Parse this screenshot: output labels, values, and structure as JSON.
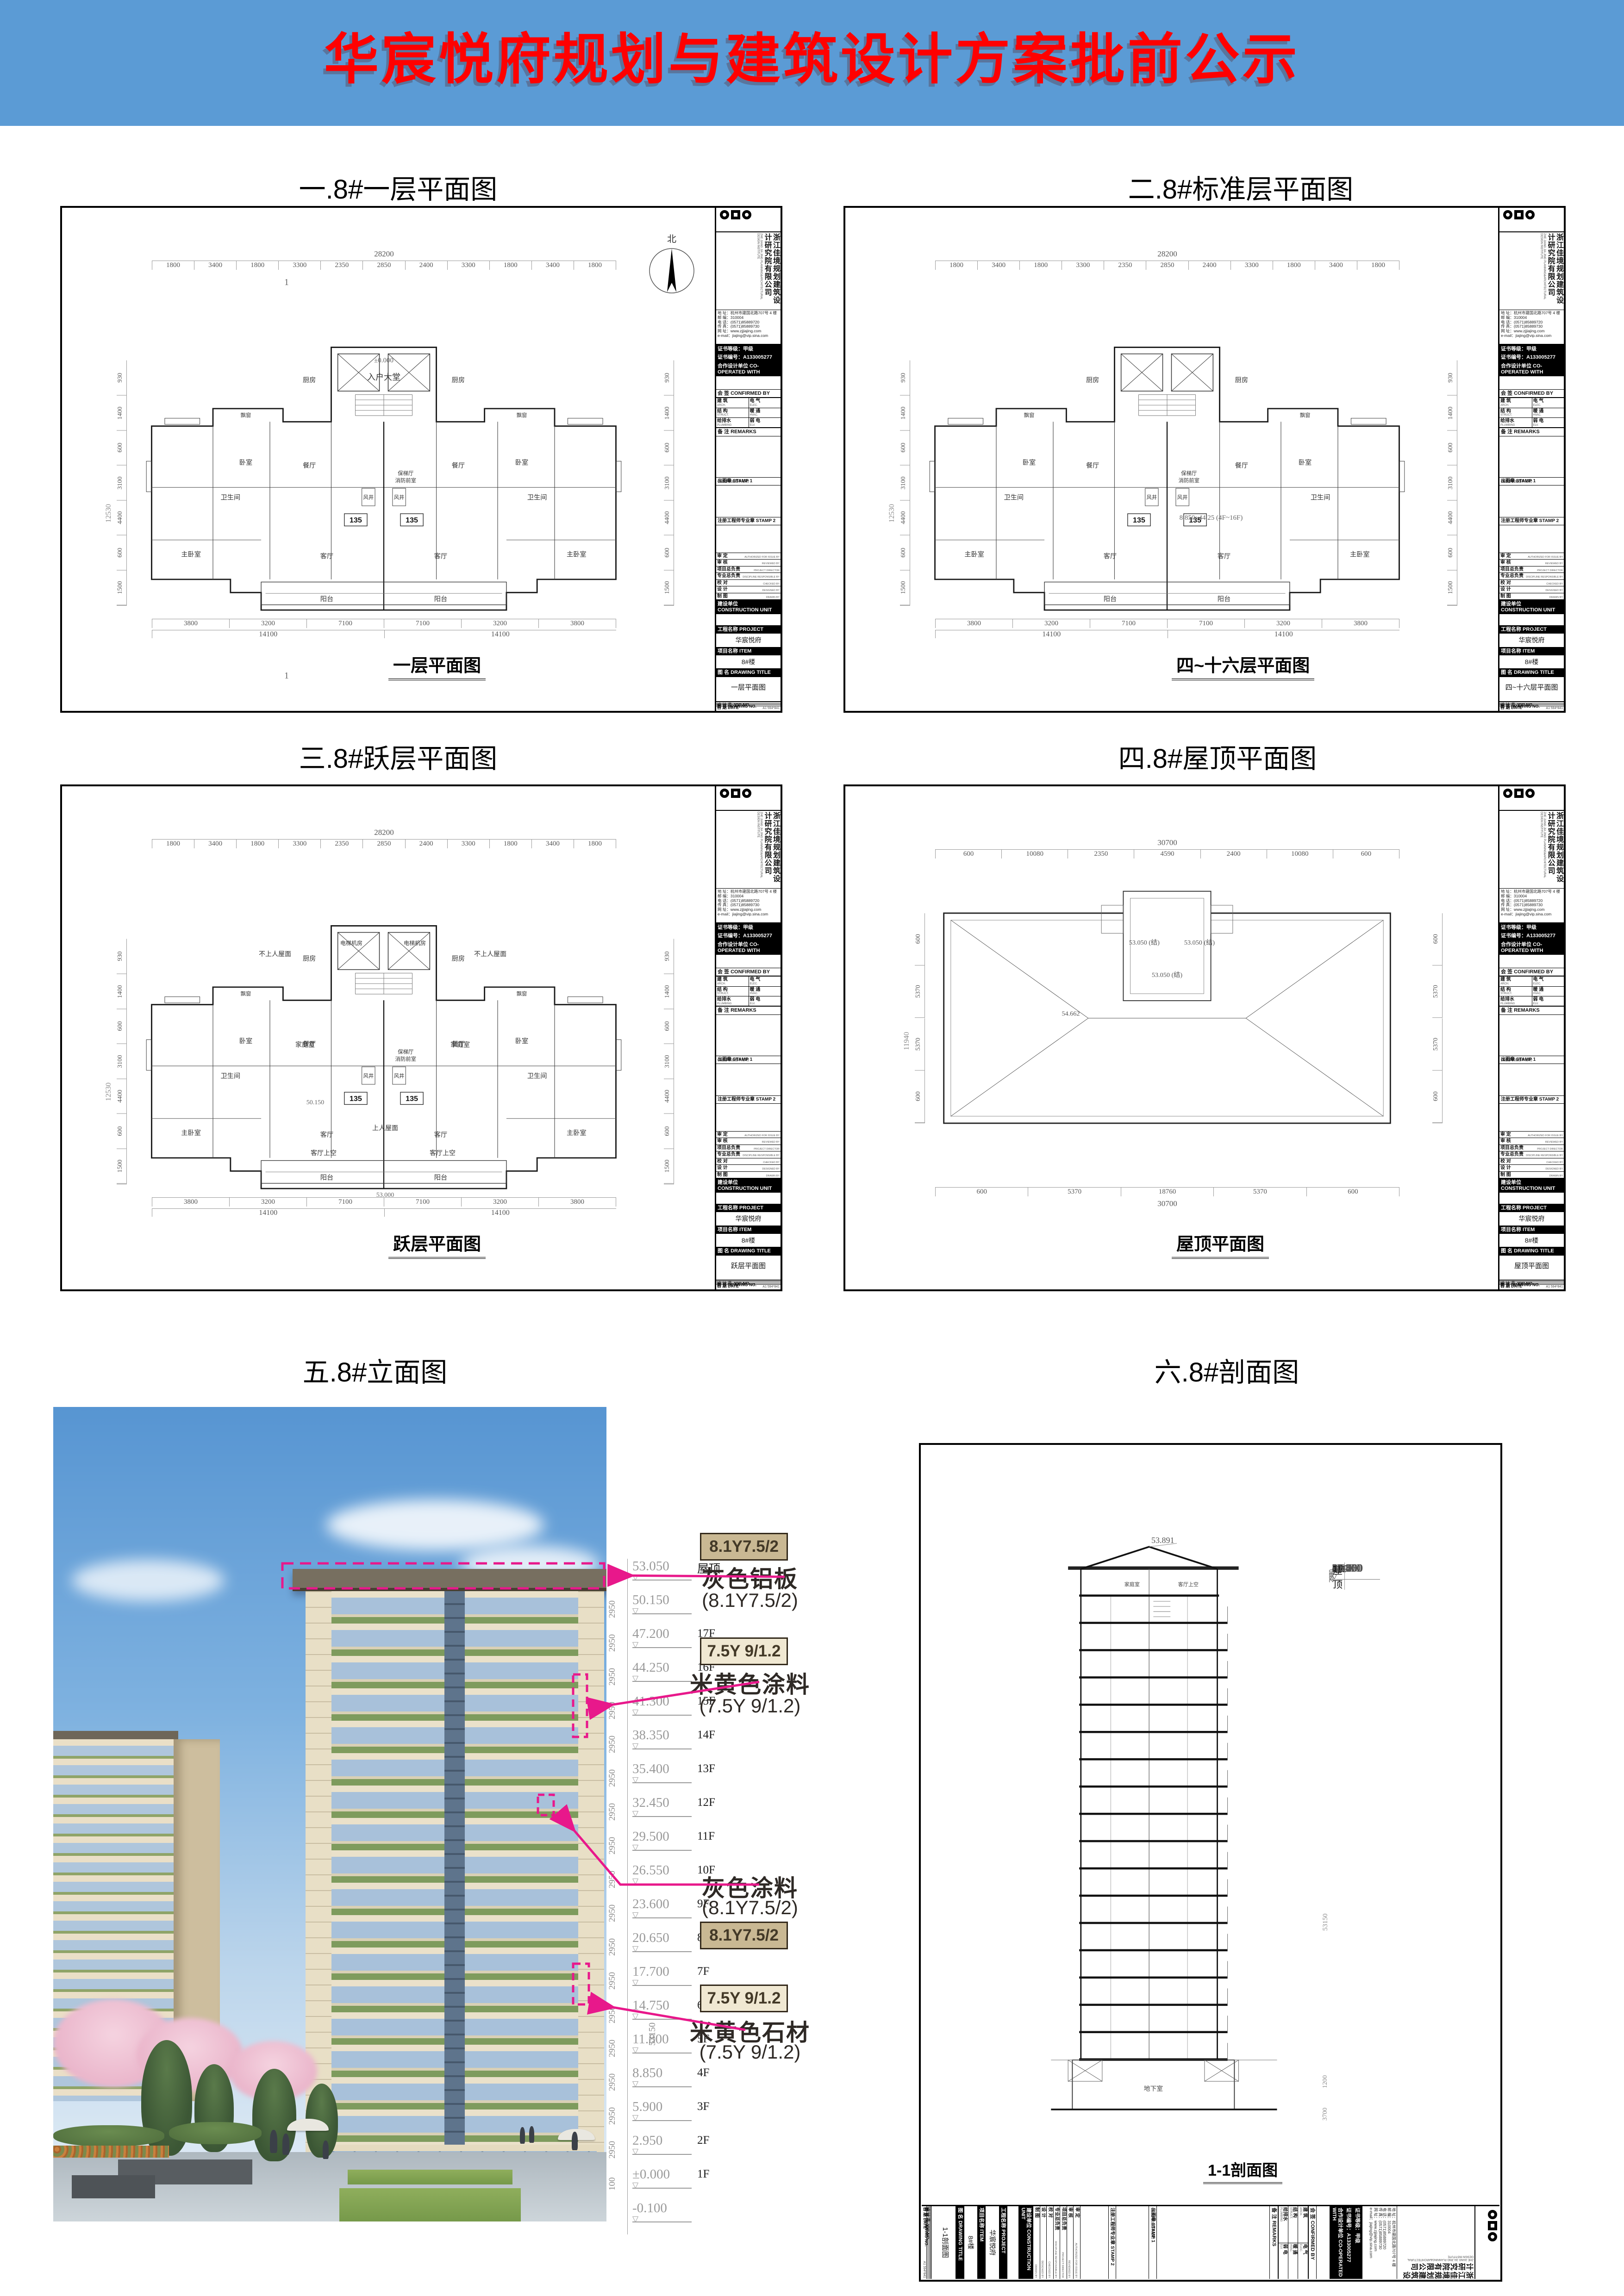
{
  "colors": {
    "header_bg": "#5B9BD5",
    "header_fg": "#FF0000",
    "accent": "#E8188B",
    "swatch_tan": "#C9B893",
    "swatch_cream": "#F0E8D2"
  },
  "header": {
    "title": "华宸悦府规划与建筑设计方案批前公示"
  },
  "sections": {
    "s1": "一.8#一层平面图",
    "s2": "二.8#标准层平面图",
    "s3": "三.8#跃层平面图",
    "s4": "四.8#屋顶平面图",
    "s5": "五.8#立面图",
    "s6": "六.8#剖面图"
  },
  "panels": {
    "p1": {
      "dwg": "一层平面图"
    },
    "p2": {
      "dwg": "四~十六层平面图"
    },
    "p3": {
      "dwg": "跃层平面图"
    },
    "p4": {
      "dwg": "屋顶平面图"
    },
    "p6": {
      "dwg": "1-1剖面图"
    }
  },
  "tb": {
    "company_cn": "浙江佳境规划建筑设计研究院有限公司",
    "company_en": "ZHE JIANG JIA JING PLANNING&ARCHITECTURAL DESIGN INSTITUTE",
    "addr": "地 址：杭州市建国北路707号 4 楼",
    "zip": "邮 编：310004",
    "tel": "电 话：(0571)85889720",
    "fax": "传 真：(0571)85889730",
    "web": "网 址：www.zjjiajing.com",
    "email": "e-mail：jiajing@vip.sina.com",
    "cert_grade": "证书等级：甲级",
    "cert_no": "证书编号：A133005277",
    "coop": "合作设计单位 CO-OPERATED WITH",
    "confirm_title": "会 签  CONFIRMED BY",
    "confirm_cells": [
      {
        "cn": "建 筑",
        "en": "ARCH."
      },
      {
        "cn": "电 气",
        "en": "ELEC."
      },
      {
        "cn": "结 构",
        "en": "STRUCT."
      },
      {
        "cn": "暖 通",
        "en": "HVAC."
      },
      {
        "cn": "给排水",
        "en": "PLUMBING"
      },
      {
        "cn": "弱 电",
        "en": "ELV."
      }
    ],
    "remarks": "备 注  REMARKS",
    "stamp1": "出图章 STAMP 1",
    "stamp1_note": "(未盖本院出图章无效)",
    "stamp2": "注册工程师专业章  STAMP 2",
    "approvals": [
      {
        "cn": "审 定",
        "en": "AUTHORIZED FOR ISSUE BY"
      },
      {
        "cn": "审 核",
        "en": "REVIEWED BY"
      },
      {
        "cn": "项目总负责",
        "en": "PROJECT DIRECTOR"
      },
      {
        "cn": "专业总负责",
        "en": "DISCIPLINE RESPONSIBLE BY"
      },
      {
        "cn": "校 对",
        "en": "CHECKED BY"
      },
      {
        "cn": "设 计",
        "en": "DESIGNED BY"
      },
      {
        "cn": "制 图",
        "en": "DRAWN BY"
      }
    ],
    "construction": "建设单位 CONSTRUCTION UNIT",
    "project_label": "工程名称 PROJECT",
    "project_value": "华宸悦府",
    "item_label": "项目名称 ITEM",
    "item_value": "8#楼",
    "dwg_label": "图      名 DRAWING TITLE",
    "job_no": "设 计 号  JOB NO.",
    "dwg_no": "图      号  DRAWING NO.",
    "date": "日      期  DATE",
    "sheet_note": "A1 594*841"
  },
  "plan": {
    "total_top": "28200",
    "dims_top": [
      "1800",
      "3400",
      "1800",
      "3300",
      "2350",
      "2850",
      "2400",
      "3300",
      "1800",
      "3400",
      "1800"
    ],
    "total_side": "12530",
    "dims_side": [
      "930",
      "1400",
      "600",
      "3100",
      "4400",
      "600",
      "1500"
    ],
    "dims_bottom": [
      "3800",
      "3200",
      "7100",
      "7100",
      "3200",
      "3800"
    ],
    "totals_bottom": [
      "14100",
      "14100"
    ],
    "rooms": {
      "kitchen": "厨房",
      "dining": "餐厅",
      "living": "客厅",
      "bed": "卧室",
      "master": "主卧室",
      "bath": "卫生间",
      "balcony": "阳台",
      "bay": "飘窗",
      "shaft": "风井",
      "lobby": "保梯厅",
      "firefront": "消防前室",
      "unit": "135",
      "up": "上",
      "down": "下"
    },
    "p1": {
      "entry": "入户大堂",
      "zero": "±0.000",
      "mark": "1",
      "north": "北"
    },
    "p2": {
      "range": "8.850~44.25 (4F~16F)"
    },
    "p3": {
      "no_access": "不上人屋面",
      "machine": "电梯机房",
      "family": "家庭室",
      "void_": "客厅上空",
      "lv1": "50.150",
      "lv2": "53.000",
      "access": "上人屋面"
    }
  },
  "roof": {
    "total_top": "30700",
    "dims_top": [
      "600",
      "10080",
      "2350",
      "4590",
      "2400",
      "10080",
      "600"
    ],
    "total_side": "11940",
    "dims_side": [
      "600",
      "5370",
      "5370",
      "600"
    ],
    "dims_bottom": [
      "600",
      "5370",
      "18760",
      "5370",
      "600"
    ],
    "total_bottom": "30700",
    "lv": "53.050 (结)",
    "ridge": "54.662"
  },
  "levels": [
    {
      "v": "53.050",
      "f": "屋顶",
      "d": "2900"
    },
    {
      "v": "50.150",
      "f": "",
      "d": "2950"
    },
    {
      "v": "47.200",
      "f": "17F",
      "d": "2950"
    },
    {
      "v": "44.250",
      "f": "16F",
      "d": "2950"
    },
    {
      "v": "41.300",
      "f": "15F",
      "d": "2950"
    },
    {
      "v": "38.350",
      "f": "14F",
      "d": "2950"
    },
    {
      "v": "35.400",
      "f": "13F",
      "d": "2950"
    },
    {
      "v": "32.450",
      "f": "12F",
      "d": "2950"
    },
    {
      "v": "29.500",
      "f": "11F",
      "d": "2950"
    },
    {
      "v": "26.550",
      "f": "10F",
      "d": "2950"
    },
    {
      "v": "23.600",
      "f": "9F",
      "d": "2950"
    },
    {
      "v": "20.650",
      "f": "8F",
      "d": "2950"
    },
    {
      "v": "17.700",
      "f": "7F",
      "d": "2950"
    },
    {
      "v": "14.750",
      "f": "6F",
      "d": "2950"
    },
    {
      "v": "11.800",
      "f": "5F",
      "d": "2950"
    },
    {
      "v": "8.850",
      "f": "4F",
      "d": "2950"
    },
    {
      "v": "5.900",
      "f": "3F",
      "d": "2950"
    },
    {
      "v": "2.950",
      "f": "2F",
      "d": "2950"
    },
    {
      "v": "±0.000",
      "f": "1F",
      "d": "100"
    },
    {
      "v": "-0.100",
      "f": "",
      "d": ""
    }
  ],
  "elev": {
    "total": "53150"
  },
  "section": {
    "peak": "53.891",
    "basement": "地下室",
    "dim_base": "1200",
    "dim_pit": "3700",
    "total": "53150"
  },
  "materials": {
    "sw_gray": "8.1Y7.5/2",
    "sw_beige": "7.5Y 9/1.2",
    "m1": {
      "name": "灰色铝板",
      "code": "(8.1Y7.5/2)"
    },
    "m2": {
      "name": "米黄色涂料",
      "code": "(7.5Y 9/1.2)"
    },
    "m3": {
      "name": "灰色涂料",
      "code": "(8.1Y7.5/2)"
    },
    "m4": {
      "name": "米黄色石材",
      "code": "(7.5Y 9/1.2)"
    }
  }
}
